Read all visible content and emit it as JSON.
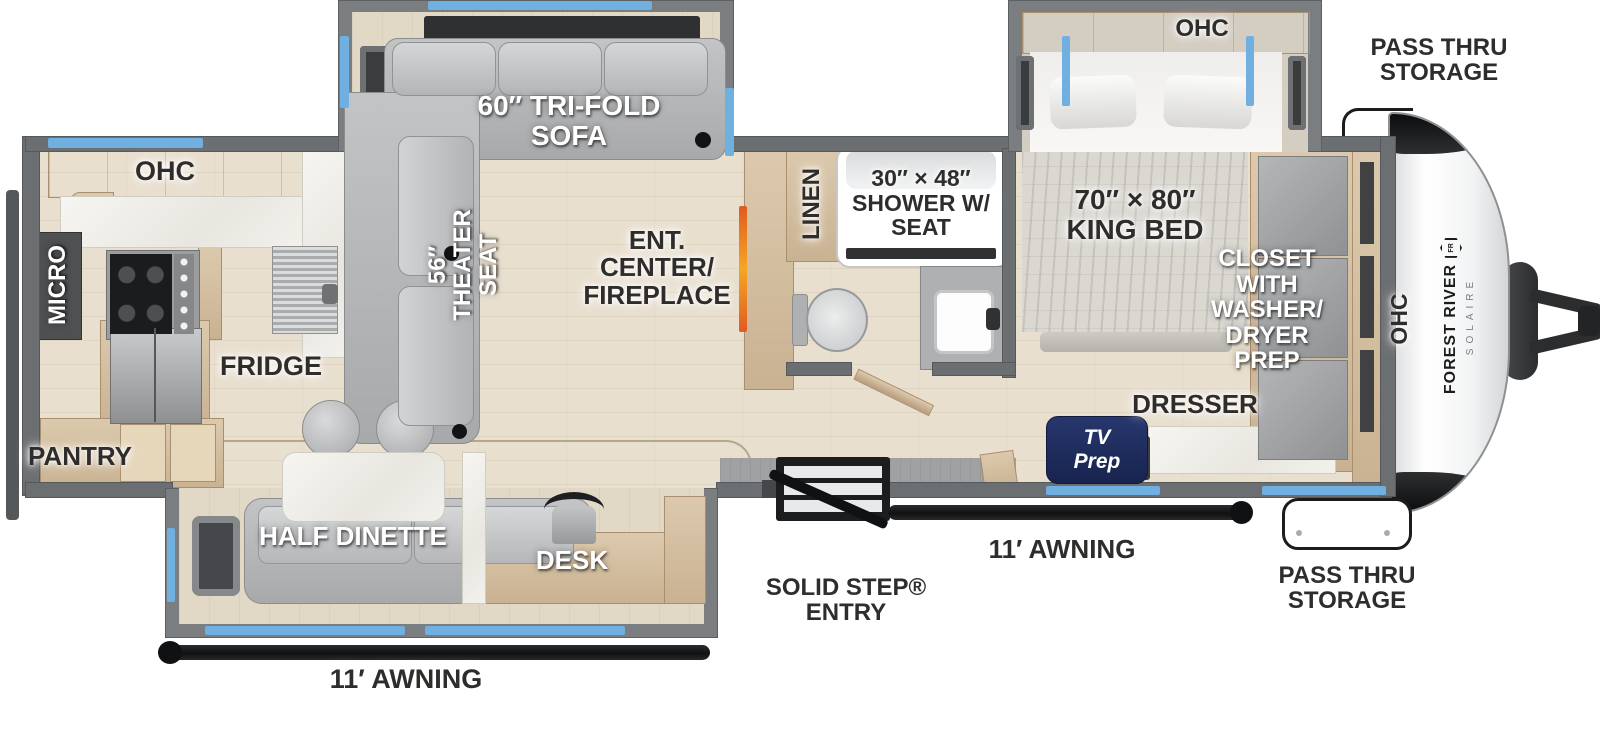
{
  "floorplan": {
    "brand": {
      "line1": "FOREST RIVER",
      "line2": "SOLAIRE",
      "logo": "FR"
    },
    "labels": {
      "kitchen_ohc": "OHC",
      "micro": "MICRO",
      "fridge": "FRIDGE",
      "pantry": "PANTRY",
      "tri_fold_sofa": "60″ TRI-FOLD\nSOFA",
      "theater_seat": "56″\nTHEATER\nSEAT",
      "ent_center": "ENT.\nCENTER/\nFIREPLACE",
      "linen": "LINEN",
      "shower": "30″ × 48″\nSHOWER W/\nSEAT",
      "king_bed": "70″ × 80″\nKING BED",
      "bedroom_ohc": "OHC",
      "closet": "CLOSET\nWITH\nWASHER/\nDRYER\nPREP",
      "dresser": "DRESSER",
      "tv_prep": "TV\nPrep",
      "front_ohc": "OHC",
      "half_dinette": "HALF DINETTE",
      "desk": "DESK",
      "awning_left": "11′ AWNING",
      "awning_right": "11′ AWNING",
      "solid_step_entry": "SOLID STEP®\nENTRY",
      "pass_thru_top": "PASS THRU\nSTORAGE",
      "pass_thru_bottom": "PASS THRU\nSTORAGE"
    },
    "colors": {
      "wall": "#6c6f71",
      "floor": "#e9dfcf",
      "window_accent": "#6fb0e0",
      "awning": "#17181a",
      "wood": "#d5c1a4",
      "marble": "#f3f2ee",
      "upholstery": "#b7b8ba",
      "tv_prep_badge": "#1e2a5a",
      "fireplace": "#e8742c",
      "label_dark": "#2e2d2b",
      "label_light": "#ffffff"
    }
  }
}
